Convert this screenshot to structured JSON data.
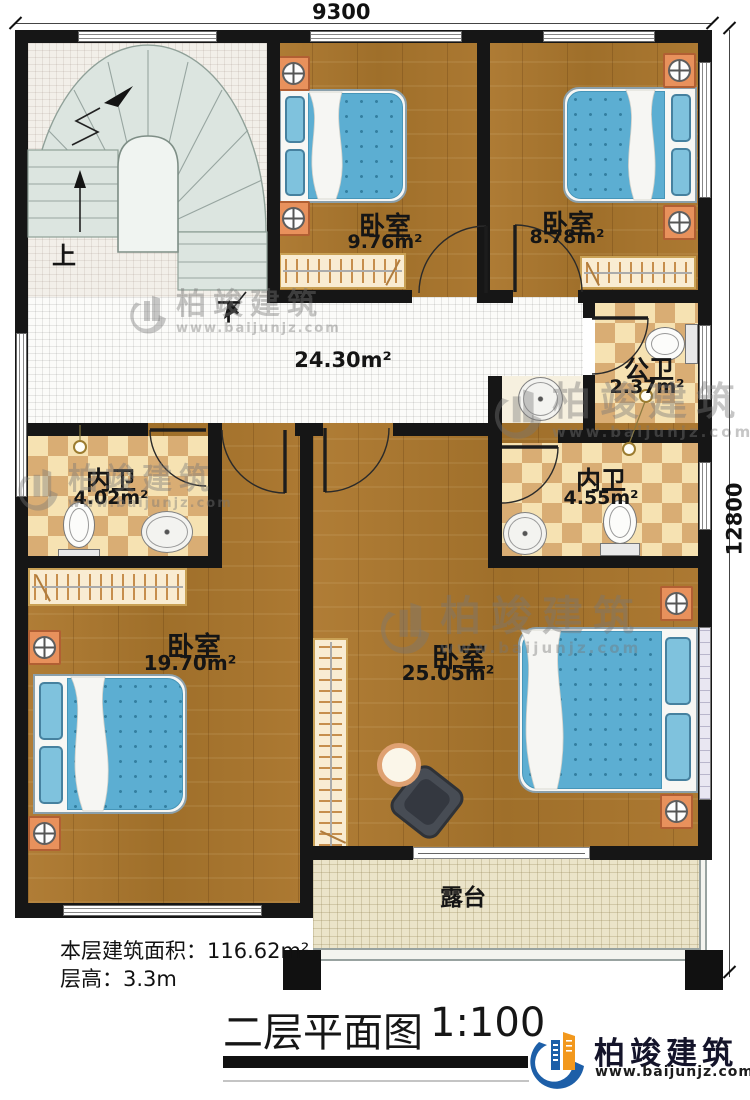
{
  "plan": {
    "dim_top": "9300",
    "dim_right": "12800",
    "stair_up": "上",
    "stair_down": "下",
    "hall_area": "24.30m²",
    "rooms": {
      "bed_top_mid": {
        "name": "卧室",
        "area": "9.76m²"
      },
      "bed_top_right": {
        "name": "卧室",
        "area": "8.78m²"
      },
      "public_bath": {
        "name": "公卫",
        "area": "2.37m²"
      },
      "ensuite_left": {
        "name": "内卫",
        "area": "4.02m²"
      },
      "ensuite_right": {
        "name": "内卫",
        "area": "4.55m²"
      },
      "bed_bottom_left": {
        "name": "卧室",
        "area": "19.70m²"
      },
      "bed_bottom_right": {
        "name": "卧室",
        "area": "25.05m²"
      },
      "terrace": {
        "name": "露台"
      }
    }
  },
  "footer": {
    "floor_area": "本层建筑面积：116.62m²",
    "floor_height": "层高：3.3m",
    "title": "二层平面图",
    "scale": "1:100"
  },
  "brand": {
    "name": "柏竣建筑",
    "url": "www.baijunjz.com"
  },
  "watermark": {
    "name": "柏竣建筑",
    "url": "www.baijunjz.com"
  },
  "colors": {
    "wall": "#161616",
    "wood_floor": "#a97a33",
    "bath_checker": "#d9ad74",
    "bed_blue": "#5caed2",
    "nightstand_orange": "#e8915c",
    "brand_blue": "#1d5fa8",
    "brand_orange": "#f2981d"
  }
}
